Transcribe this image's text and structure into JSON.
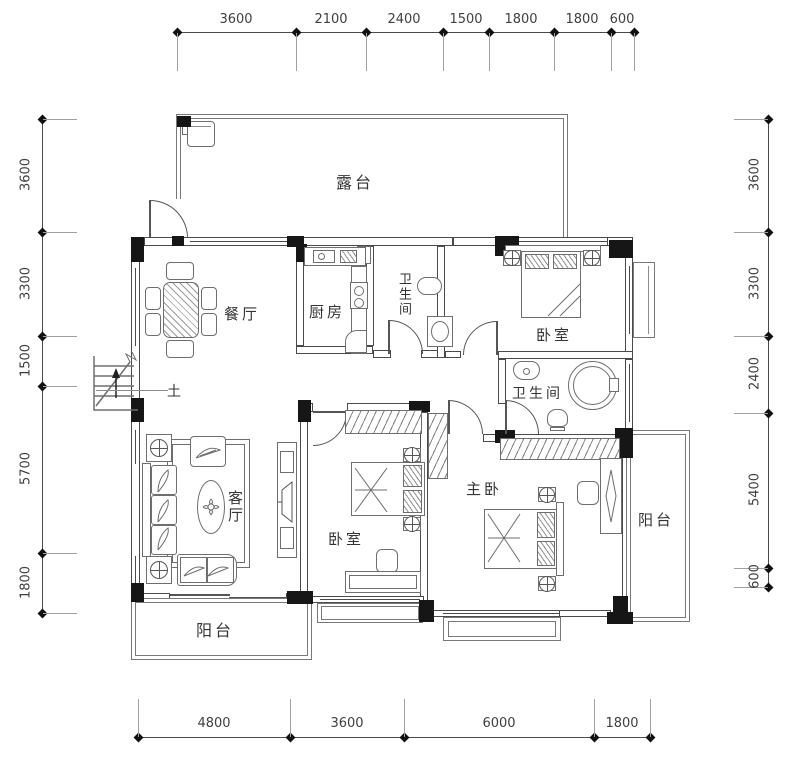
{
  "rooms": {
    "terrace": "露台",
    "dining": "餐厅",
    "kitchen": "厨房",
    "bath1": "卫生间",
    "bedroom1": "卧室",
    "bath2": "卫生间",
    "master": "主卧",
    "living": "客厅",
    "bedroom2": "卧室",
    "balcony_right": "阳台",
    "balcony_left": "阳台"
  },
  "annotations": {
    "stair_mark": "土"
  },
  "dimensions": {
    "top": [
      "3600",
      "2100",
      "2400",
      "1500",
      "1800",
      "1800",
      "600"
    ],
    "bottom": [
      "4800",
      "3600",
      "6000",
      "1800"
    ],
    "left": [
      "3600",
      "3300",
      "1500",
      "5700",
      "1800"
    ],
    "right": [
      "3600",
      "3300",
      "2400",
      "5400",
      "600"
    ]
  },
  "colors": {
    "wall_line": "#4a4a4a",
    "column": "#161616",
    "furniture_line": "#6e6e6e",
    "dimension_text": "#3f3f3f",
    "label_text": "#343434",
    "background": "#ffffff"
  }
}
